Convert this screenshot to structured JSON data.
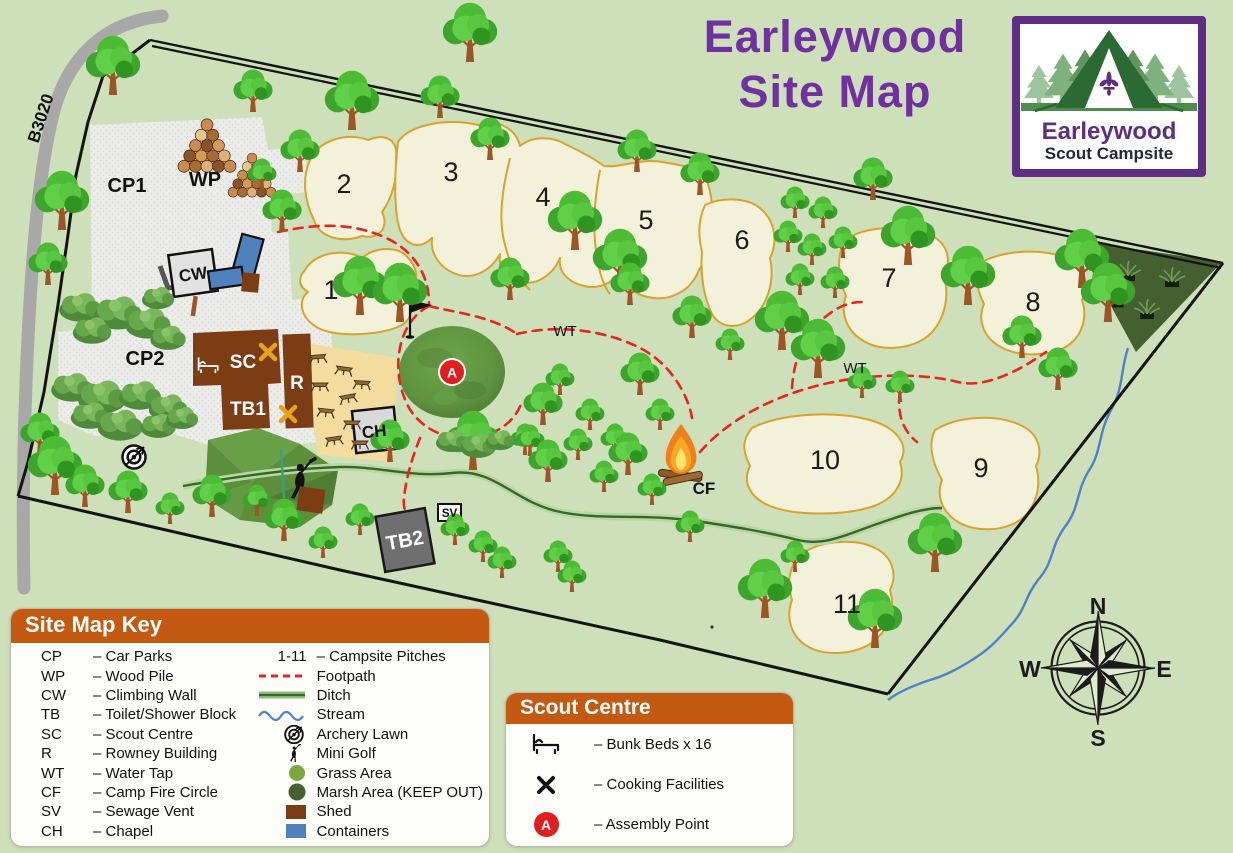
{
  "title": {
    "line1": "Earleywood",
    "line2": "Site Map"
  },
  "logo": {
    "name": "Earleywood",
    "subtitle": "Scout Campsite"
  },
  "map": {
    "road_label": "B3020",
    "labels": {
      "cp1": "CP1",
      "cp2": "CP2",
      "wp": "WP",
      "cw": "CW",
      "sc": "SC",
      "r": "R",
      "tb1": "TB1",
      "tb2": "TB2",
      "ch": "CH",
      "sv": "SV",
      "cf": "CF",
      "wt": "WT",
      "assembly": "A"
    },
    "pitches": [
      "1",
      "2",
      "3",
      "4",
      "5",
      "6",
      "7",
      "8",
      "9",
      "10",
      "11"
    ]
  },
  "compass": {
    "n": "N",
    "e": "E",
    "s": "S",
    "w": "W"
  },
  "site_key": {
    "header": "Site Map Key",
    "left": [
      {
        "code": "CP",
        "label": "– Car Parks"
      },
      {
        "code": "WP",
        "label": "– Wood Pile"
      },
      {
        "code": "CW",
        "label": "– Climbing Wall"
      },
      {
        "code": "TB",
        "label": "– Toilet/Shower Block"
      },
      {
        "code": "SC",
        "label": "– Scout Centre"
      },
      {
        "code": "R",
        "label": "– Rowney Building"
      },
      {
        "code": "WT",
        "label": "– Water Tap"
      },
      {
        "code": "CF",
        "label": "– Camp Fire Circle"
      },
      {
        "code": "SV",
        "label": "– Sewage Vent"
      },
      {
        "code": "CH",
        "label": "– Chapel"
      }
    ],
    "right": [
      {
        "code": "1-11",
        "label": "– Campsite Pitches"
      },
      {
        "label": "Footpath"
      },
      {
        "label": "Ditch"
      },
      {
        "label": "Stream"
      },
      {
        "label": "Archery Lawn"
      },
      {
        "label": "Mini Golf"
      },
      {
        "label": "Grass Area"
      },
      {
        "label": "Marsh Area (KEEP OUT)"
      },
      {
        "label": "Shed"
      },
      {
        "label": "Containers"
      }
    ]
  },
  "scout_centre": {
    "header": "Scout Centre",
    "items": [
      {
        "label": "– Bunk Beds x 16"
      },
      {
        "label": "– Cooking Facilities"
      },
      {
        "label": "– Assembly Point"
      }
    ]
  },
  "colors": {
    "background_green": "#cde0ba",
    "accent_purple": "#7030a0",
    "logo_purple": "#5e2d84",
    "header_orange": "#c45911",
    "footpath_red": "#e8251d",
    "assembly_red": "#e11d1d",
    "pitch_fill": "#f4f1da",
    "pitch_outline": "#d8a32c",
    "building_brown": "#7c3d14",
    "container_blue": "#4f81bd",
    "marsh_green": "#465f31",
    "stream_blue": "#4f81c7"
  }
}
